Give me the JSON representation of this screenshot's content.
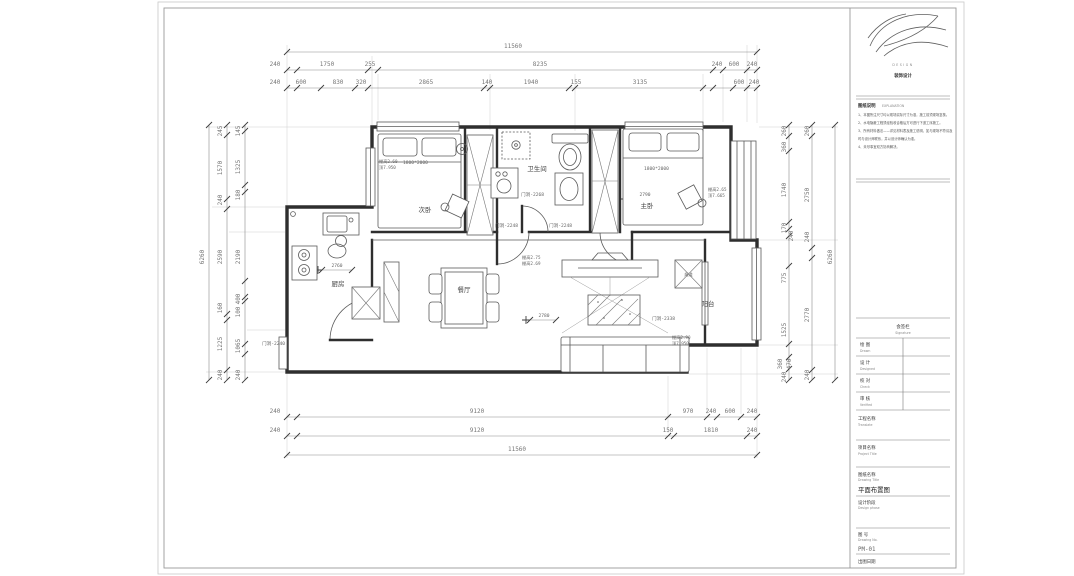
{
  "logo": {
    "en": "DESIGN",
    "cn": "装饰设计"
  },
  "explanation": {
    "cn": "图纸说明",
    "en": "EXPLANATION",
    "notes": [
      "1、本图所注尺寸均以现场实际尺寸为准，施工前须现场复核。",
      "2、水电隐蔽工程须经验收合格后方可进行下道工序施工。",
      "3、所有材料做法——详见材料表及施工说明，如与现场不符请及",
      "时与设计师联系，并以设计师确认为准。",
      "4、未尽事宜双方协商解决。"
    ]
  },
  "signoff": {
    "header_cn": "会签栏",
    "header_en": "Signature",
    "rows": [
      {
        "cn": "绘  图",
        "en": "Drawn"
      },
      {
        "cn": "设  计",
        "en": "Designed"
      },
      {
        "cn": "校  对",
        "en": "Check"
      },
      {
        "cn": "审  核",
        "en": "Verified"
      }
    ],
    "translate_cn": "工程名称",
    "translate_en": "Translate"
  },
  "fields": {
    "project_cn": "项目名称",
    "project_en": "Project Title",
    "drawing_cn": "图纸名称",
    "drawing_en": "Drawing Title",
    "drawing_value": "平面布置图",
    "phase_cn": "设计阶段",
    "phase_en": "Design phase",
    "no_cn": "图  号",
    "no_en": "Drawing No.",
    "no_value": "PM-01",
    "date_cn": "出图日期"
  },
  "rooms": {
    "bedroom": "次卧",
    "master": "主卧",
    "bath": "卫生间",
    "kitchen": "厨房",
    "dining": "餐厅",
    "balcony": "阳台",
    "flue": "烟道"
  },
  "doors": {
    "kitchen": "门洞-2240",
    "bedroom": "门洞-2248",
    "hall": "门洞-2248",
    "bath": "门洞-2268",
    "balcony": "门洞-2338"
  },
  "furniture": {
    "bed1": "1800*2000",
    "bed2": "1800*2000"
  },
  "annotations": {
    "a1": [
      "棚高2.60",
      "顶7.950"
    ],
    "a2": [
      "棚高2.65",
      "顶7.665"
    ],
    "a3": [
      "棚高2.75",
      "棚高2.69"
    ],
    "a4": [
      "棚高2.90",
      "顶7.950"
    ]
  },
  "dims": {
    "top1": "11560",
    "top2": [
      "240",
      "1750",
      "255",
      "8235",
      "240",
      "600",
      "240"
    ],
    "top3": [
      "240",
      "600",
      "830",
      "320",
      "2865",
      "140",
      "1940",
      "155",
      "3135",
      "600",
      "240"
    ],
    "bottom1": [
      "240",
      "9120",
      "970",
      "240",
      "600",
      "240"
    ],
    "bottom2": [
      "240",
      "9120",
      "150",
      "1810",
      "240"
    ],
    "bottom3": "11560",
    "left_total": "6260",
    "left_outer": [
      "245",
      "1570",
      "240",
      "2590",
      "160",
      "1225",
      "240"
    ],
    "left_inner": [
      "145",
      "1325",
      "180",
      "2190",
      "400",
      "100",
      "1065",
      "240"
    ],
    "right_inner": [
      "260",
      "360",
      "1740",
      "170",
      "240",
      "775",
      "1525",
      "360",
      "470",
      "240"
    ],
    "right_mid": [
      "260",
      "2750",
      "240",
      "2770",
      "240"
    ],
    "right_total": "6260",
    "k2760": "2760",
    "l2780": "2780",
    "m2790": "2790"
  }
}
